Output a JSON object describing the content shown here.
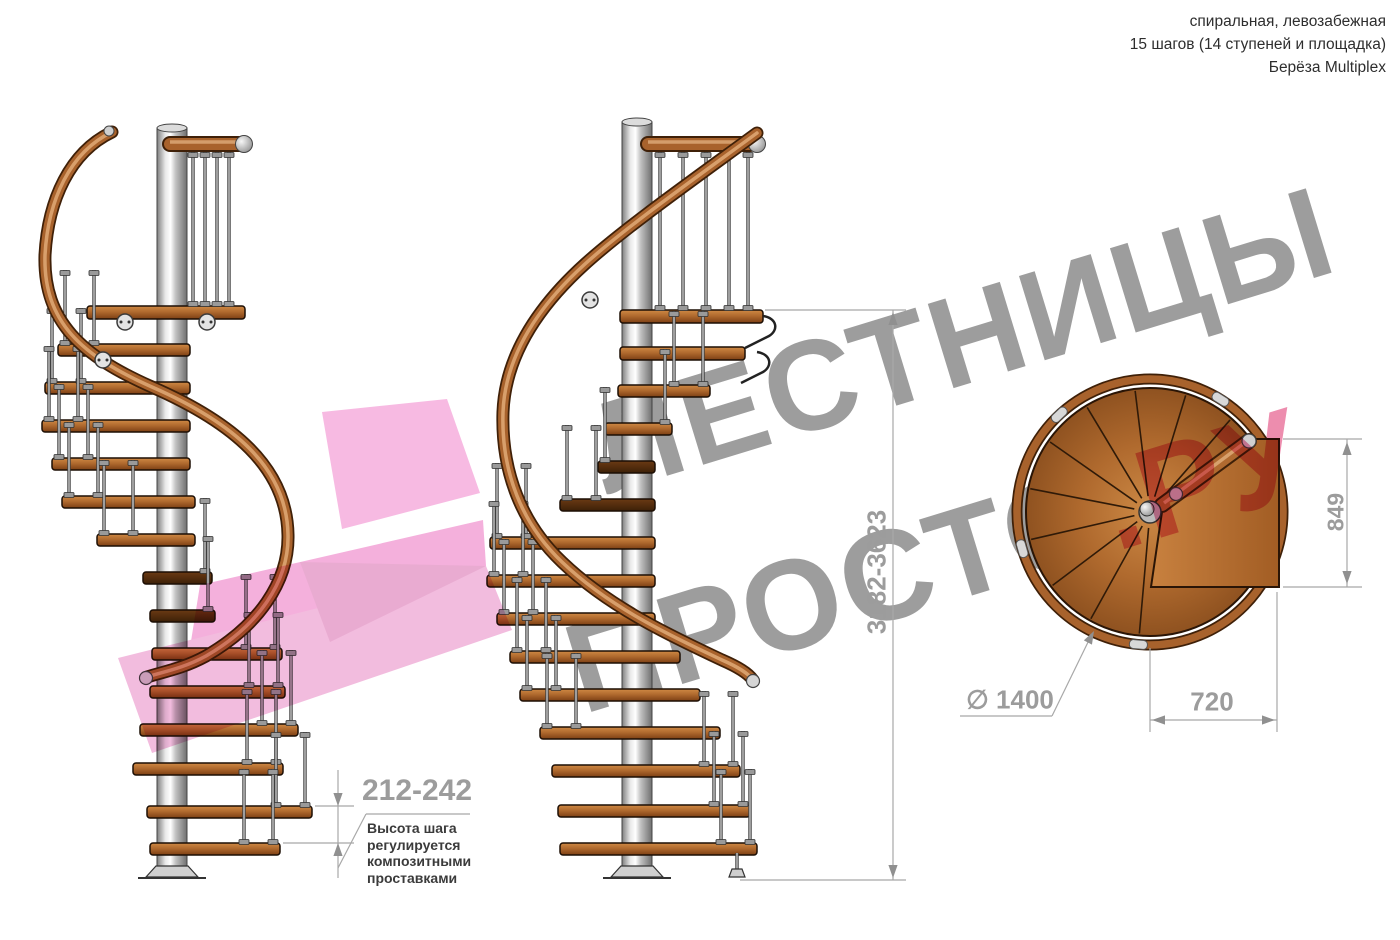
{
  "header": {
    "line1": "спиральная, левозабежная",
    "line2": "15 шагов (14 ступеней и площадка)",
    "line3": "Берёза Multiplex"
  },
  "watermark": {
    "word1": "ЛЕСТНИЦЫ",
    "word2": "ПРОСТО",
    "suffix": ".РУ",
    "gray_color": "#9d9d9d",
    "pink_color": "#e2477c",
    "arrow_color": "#f2a8d8"
  },
  "dimensions": {
    "step_height_range": "212-242",
    "step_height_note": "Высота шага\nрегулируется\nкомпозитными\nпроставками",
    "total_height_range": "3182-3623",
    "platform_depth": "849",
    "platform_width": "720",
    "diameter_symbol": "∅",
    "diameter_value": "1400"
  },
  "drawing": {
    "wood_color": "#b06a2e",
    "metal_color": "#c9c9c9",
    "dark_step_color": "#4e2a10",
    "dimension_line_color": "#a8a8a8"
  }
}
